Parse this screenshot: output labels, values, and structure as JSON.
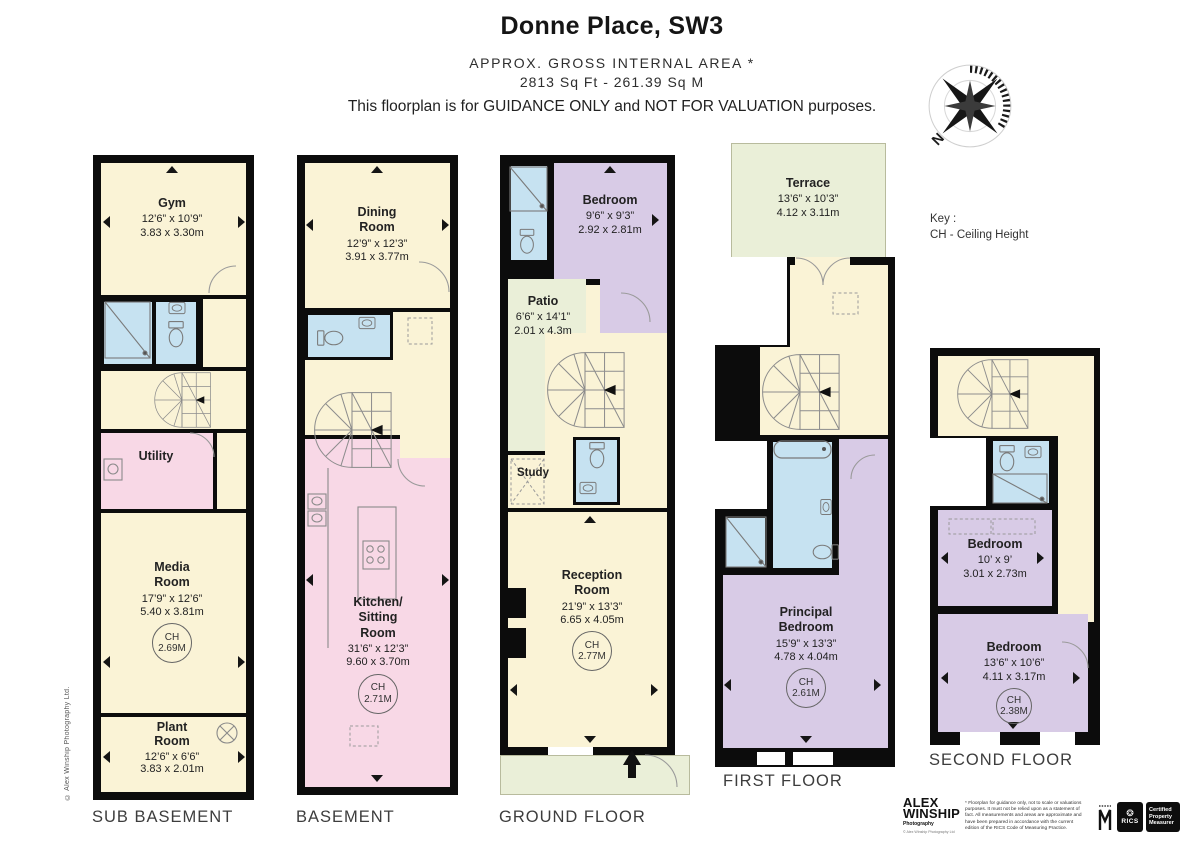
{
  "header": {
    "title": "Donne Place, SW3",
    "area_line1": "APPROX. GROSS INTERNAL  AREA *",
    "area_line2": "2813 Sq Ft  -  261.39 Sq M",
    "guidance": "This floorplan is for GUIDANCE ONLY and NOT FOR VALUATION purposes."
  },
  "compass": {
    "n": "N"
  },
  "key": {
    "line1": "Key :",
    "line2": "CH - Ceiling Height"
  },
  "side": {
    "copyright": "© Alex Winship Photography Ltd."
  },
  "floors": {
    "sub_basement": {
      "label": "SUB BASEMENT",
      "gym": {
        "name": "Gym",
        "ft": "12’6” x 10’9”",
        "m": "3.83 x 3.30m"
      },
      "utility": {
        "name": "Utility"
      },
      "media": {
        "name": "Media Room",
        "ft": "17’9” x 12’6”",
        "m": "5.40 x 3.81m",
        "ch_label": "CH",
        "ch_value": "2.69M"
      },
      "plant": {
        "name": "Plant Room",
        "ft": "12’6” x 6’6”",
        "m": "3.83 x 2.01m"
      }
    },
    "basement": {
      "label": "BASEMENT",
      "dining": {
        "name": "Dining Room",
        "ft": "12’9” x 12’3”",
        "m": "3.91 x 3.77m"
      },
      "kitchen": {
        "name": "Kitchen/ Sitting Room",
        "ft": "31’6” x 12’3”",
        "m": "9.60 x 3.70m",
        "ch_label": "CH",
        "ch_value": "2.71M"
      }
    },
    "ground": {
      "label": "GROUND FLOOR",
      "bedroom": {
        "name": "Bedroom",
        "ft": "9’6” x 9’3”",
        "m": "2.92 x 2.81m"
      },
      "patio": {
        "name": "Patio",
        "ft": "6’6” x 14’1”",
        "m": "2.01 x 4.3m"
      },
      "study": {
        "name": "Study"
      },
      "reception": {
        "name": "Reception Room",
        "ft": "21’9” x 13’3”",
        "m": "6.65 x 4.05m",
        "ch_label": "CH",
        "ch_value": "2.77M"
      }
    },
    "first": {
      "label": "FIRST FLOOR",
      "terrace": {
        "name": "Terrace",
        "ft": "13’6” x 10’3”",
        "m": "4.12 x 3.11m"
      },
      "principal": {
        "name": "Principal Bedroom",
        "ft": "15’9” x 13’3”",
        "m": "4.78 x 4.04m",
        "ch_label": "CH",
        "ch_value": "2.61M"
      }
    },
    "second": {
      "label": "SECOND FLOOR",
      "bedroom1": {
        "name": "Bedroom",
        "ft": "10’ x 9’",
        "m": "3.01 x 2.73m"
      },
      "bedroom2": {
        "name": "Bedroom",
        "ft": "13’6” x 10’6”",
        "m": "4.11 x 3.17m",
        "ch_label": "CH",
        "ch_value": "2.38M"
      }
    }
  },
  "footer": {
    "brand_top": "ALEX",
    "brand_bottom": "WINSHIP",
    "brand_sub": "Photography",
    "brand_copyright": "© Alex Winship Photography Ltd",
    "disclaimer": "* Floorplan for guidance only, not to scale or valuations purposes. It must not be relied upon as a statement of fact. All measurements and areas are approximate and have been prepared in accordance with the current edition of the RICS Code of Measuring Practice.",
    "rics": "RICS",
    "certified": "Certified Property Measurer"
  },
  "colors": {
    "wall": "#0c0c0c",
    "room_cream": "#FAF3D6",
    "room_pink": "#F8D8E6",
    "room_blue": "#C6E2F1",
    "room_purple": "#D8CBE6",
    "outdoor_green": "#EAEFD8"
  }
}
